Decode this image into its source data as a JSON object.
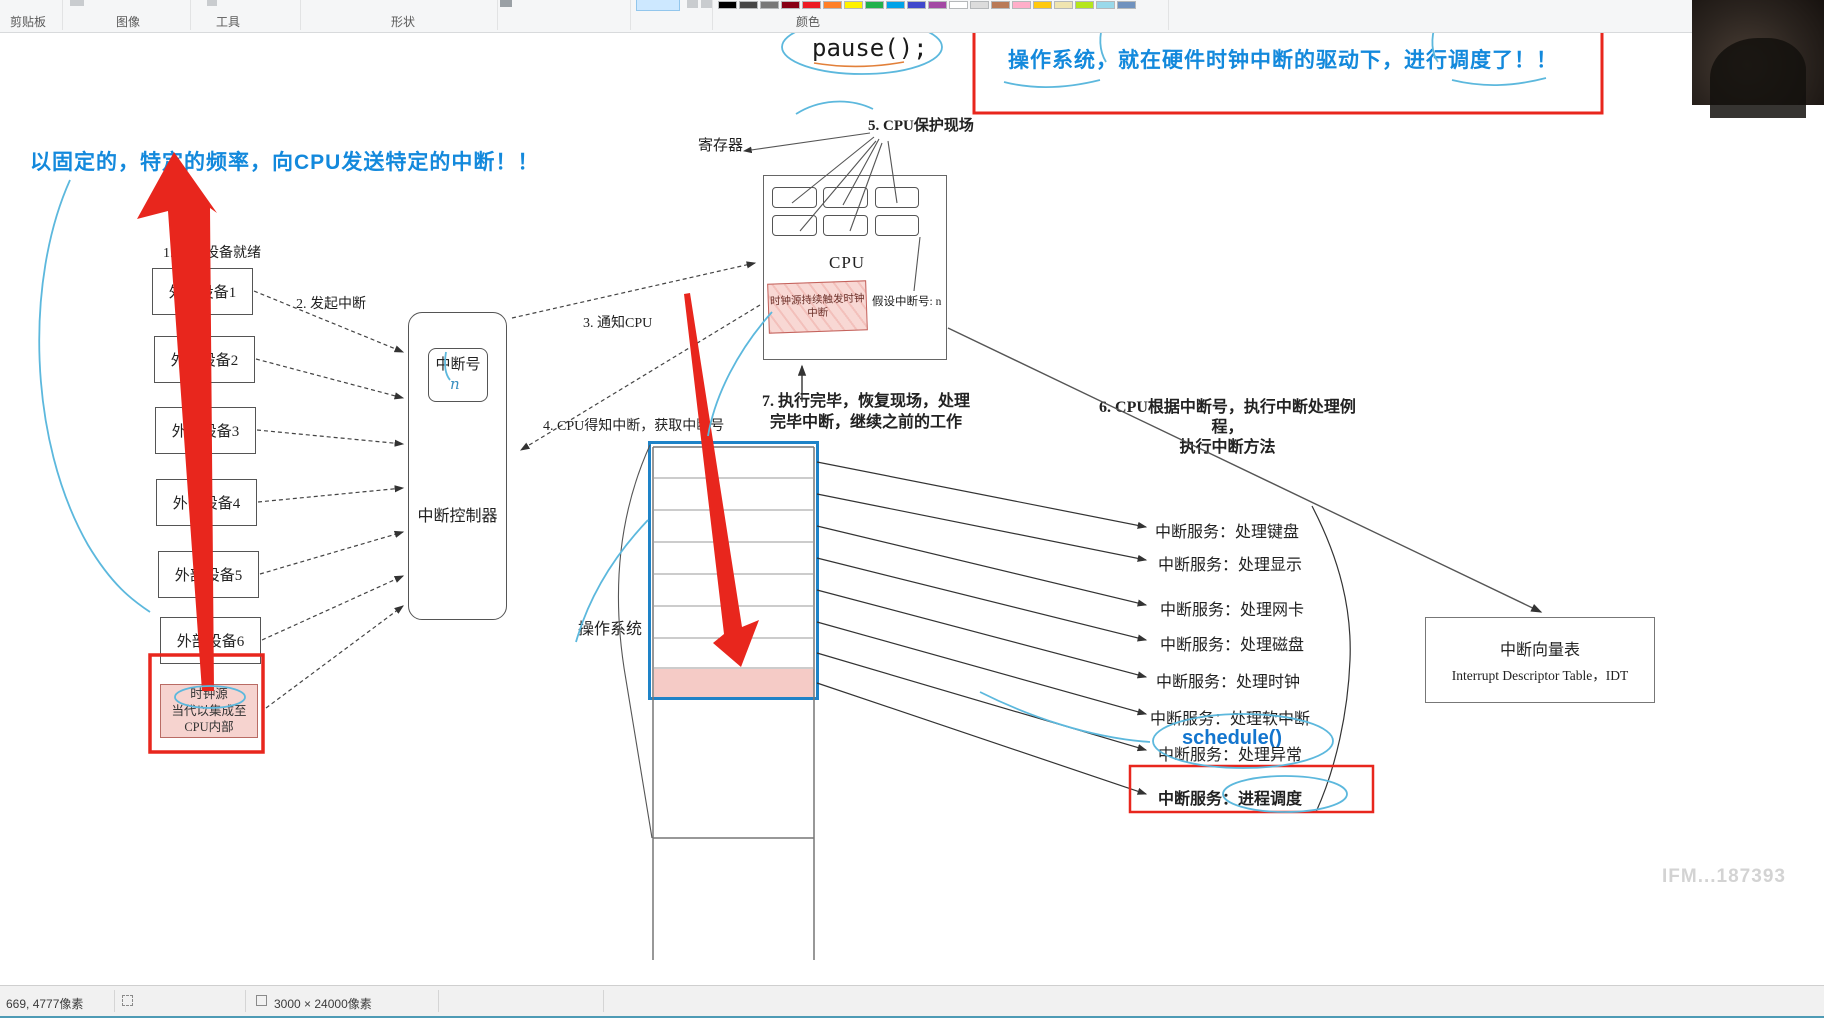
{
  "toolbar": {
    "sections": [
      "剪贴板",
      "图像",
      "工具",
      "形状",
      "颜色"
    ],
    "palette": [
      "#000000",
      "#464646",
      "#787878",
      "#880015",
      "#ed1c24",
      "#ff7f27",
      "#fff200",
      "#22b14c",
      "#00a2e8",
      "#3f48cc",
      "#a349a4",
      "#ffffff",
      "#dcdcdc",
      "#b97a57",
      "#ffaec9",
      "#ffc90e",
      "#efe4b0",
      "#b5e61d",
      "#99d9ea",
      "#7092be"
    ]
  },
  "statusbar": {
    "cursor": "669, 4777像素",
    "canvas": "3000 × 24000像素"
  },
  "watermark": "IFM...187393",
  "notes": {
    "left": "以固定的，特定的频率，向CPU发送特定的中断！！",
    "top": "操作系统，就在硬件时钟中断的驱动下，进行调度了！！",
    "pause": "pause();",
    "schedule": "schedule()"
  },
  "diagram": {
    "steps": {
      "step1": "1. 外部设备就绪",
      "step2": "2. 发起中断",
      "step3": "3. 通知CPU",
      "step4": "4. CPU得知中断，获取中断号",
      "step5": "5. CPU保护现场",
      "step6": {
        "line1": "6. CPU根据中断号，执行中断处理例程，",
        "line2": "执行中断方法"
      },
      "step7": {
        "line1": "7. 执行完毕，恢复现场，处理",
        "line2": "完毕中断，继续之前的工作"
      }
    },
    "devices": [
      "外部设备1",
      "外部设备2",
      "外部设备3",
      "外部设备4",
      "外部设备5",
      "外部设备6"
    ],
    "clock_source": {
      "title": "时钟源",
      "line2": "当代以集成至",
      "line3": "CPU内部"
    },
    "controller": {
      "label": "中断控制器",
      "number_box": "中断号",
      "number_value": "n"
    },
    "cpu": {
      "label": "CPU",
      "register_label": "寄存器",
      "clock_note_line1": "时钟源持续触发时钟",
      "clock_note_line2": "中断",
      "interrupt_hint": "假设中断号: n"
    },
    "os": {
      "label": "操作系统"
    },
    "services": [
      "中断服务：处理键盘",
      "中断服务：处理显示",
      "中断服务：处理网卡",
      "中断服务：处理磁盘",
      "中断服务：处理时钟",
      "中断服务：处理软中断",
      "中断服务：处理异常",
      "中断服务：进程调度"
    ],
    "idt": {
      "title": "中断向量表",
      "subtitle": "Interrupt Descriptor Table，IDT"
    }
  },
  "colors": {
    "accent_red": "#e8261d",
    "annotation_blue": "#1389dc",
    "frame_blue": "#1e83c8",
    "scribble_blue": "#5cb8dd"
  }
}
